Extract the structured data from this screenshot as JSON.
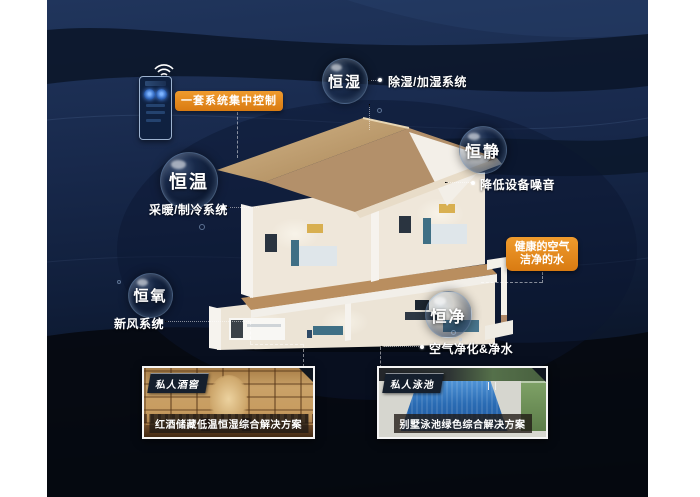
{
  "control_panel": {
    "label": "一套系统集中控制",
    "icons": [
      "wifi-icon",
      "dial-knob-icon"
    ]
  },
  "bubbles": [
    {
      "label": "恒湿",
      "note": "除湿/加湿系统"
    },
    {
      "label": "恒静",
      "note": "降低设备噪音"
    },
    {
      "label": "恒温",
      "note": "采暖/制冷系统"
    },
    {
      "label": "恒氧",
      "note": "新风系统"
    },
    {
      "label": "恒净",
      "note": "空气净化&净水"
    }
  ],
  "health_callout": {
    "line1": "健康的空气",
    "line2": "洁净的水"
  },
  "photos": [
    {
      "badge": "私人酒窖",
      "caption": "红酒储藏低温恒湿综合解决方案"
    },
    {
      "badge": "私人泳池",
      "caption": "别墅泳池绿色综合解决方案"
    }
  ],
  "colors": {
    "accent_orange": "#E0861C",
    "background_navy": "#18294C",
    "background_deep": "#04070E",
    "text_white": "#FFFFFF",
    "roof_tan": "#C2A070",
    "pool_blue": "#2A6CB4",
    "wood_brown": "#C79C60"
  }
}
